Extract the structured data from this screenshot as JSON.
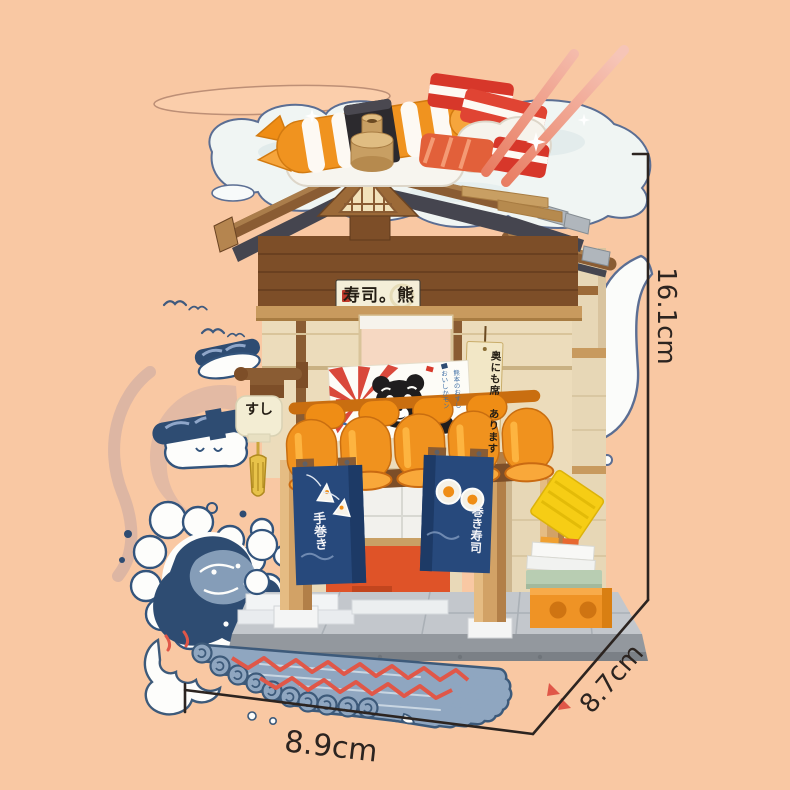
{
  "product": {
    "description": "Building-block Japanese sushi shop model product photo with size annotations"
  },
  "dimensions": {
    "height": "16.1cm",
    "depth": "8.7cm",
    "width": "8.9cm"
  },
  "signs": {
    "main_sign": "寿司。熊",
    "lantern": "すし",
    "noren_left": "手巻き",
    "noren_right": "巻き寿司",
    "side_sign_col1": "奥にも席",
    "side_sign_col2": "あります",
    "poster_col1": "熊本のおすし",
    "poster_col2": "おいしかモン"
  },
  "colors": {
    "background": "#f9c8a3",
    "dimension_line": "#2c2420",
    "roof_brown": "#8a5c33",
    "awning_orange": "#f0921e",
    "noren_navy": "#27497c",
    "wave_navy": "#2e4c72",
    "pillar_tan": "#d2a266",
    "base_gray": "#c3c7cc",
    "counter_orange": "#df5328",
    "accent_red": "#d7392b"
  }
}
